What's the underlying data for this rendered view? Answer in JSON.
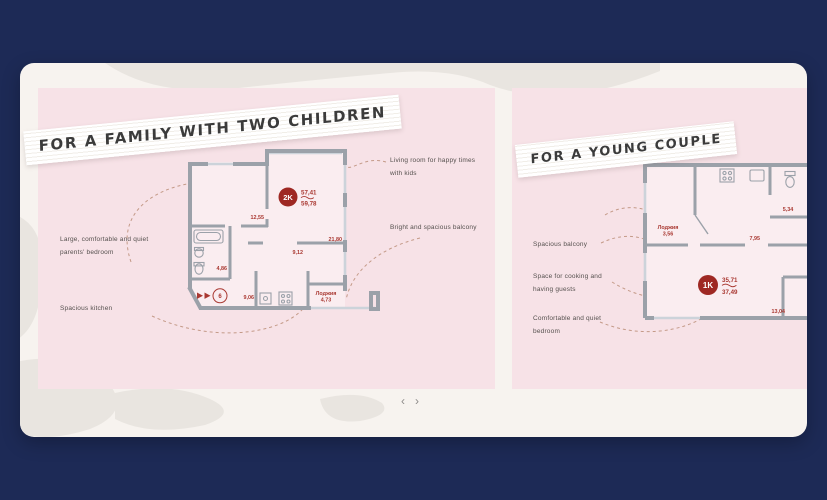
{
  "theme": {
    "background": "#1d2a56",
    "card": "#f7f3ef",
    "panel_pink": "#f7e2e7",
    "blob_gray": "#e9e5e0",
    "wall_gray": "#9ba1a9",
    "window_gray": "#ccd3da",
    "plan_red": "#a93831",
    "badge_red": "#9e2823",
    "dash_tan": "#c49a88"
  },
  "carousel": {
    "prev_label": "‹",
    "next_label": "›"
  },
  "slides": {
    "family": {
      "title": "FOR A FAMILY WITH TWO CHILDREN",
      "badge": "2K",
      "area_living": "57,41",
      "area_total": "59,78",
      "entrance_no": "6",
      "rooms": {
        "bedroom": "12,55",
        "living": "21,80",
        "hall": "9,12",
        "bath": "4,86",
        "kitchen": "9,06",
        "loggia_name": "Лоджия",
        "loggia": "4,73"
      },
      "annotations": {
        "bedroom": "Large, comfortable and quiet parents' bedroom",
        "kitchen": "Spacious kitchen",
        "living": "Living room for happy times with kids",
        "balcony": "Bright and spacious balcony"
      }
    },
    "couple": {
      "title": "FOR A YOUNG COUPLE",
      "badge": "1K",
      "area_living": "35,71",
      "area_total": "37,49",
      "rooms": {
        "loggia_name": "Лоджия",
        "loggia": "3,56",
        "bath": "5,34",
        "kitchen": "7,95",
        "bedroom": "13,04"
      },
      "annotations": {
        "balcony": "Spacious balcony",
        "kitchen": "Space for cooking and having guests",
        "bedroom": "Comfortable and quiet bedroom"
      }
    }
  }
}
